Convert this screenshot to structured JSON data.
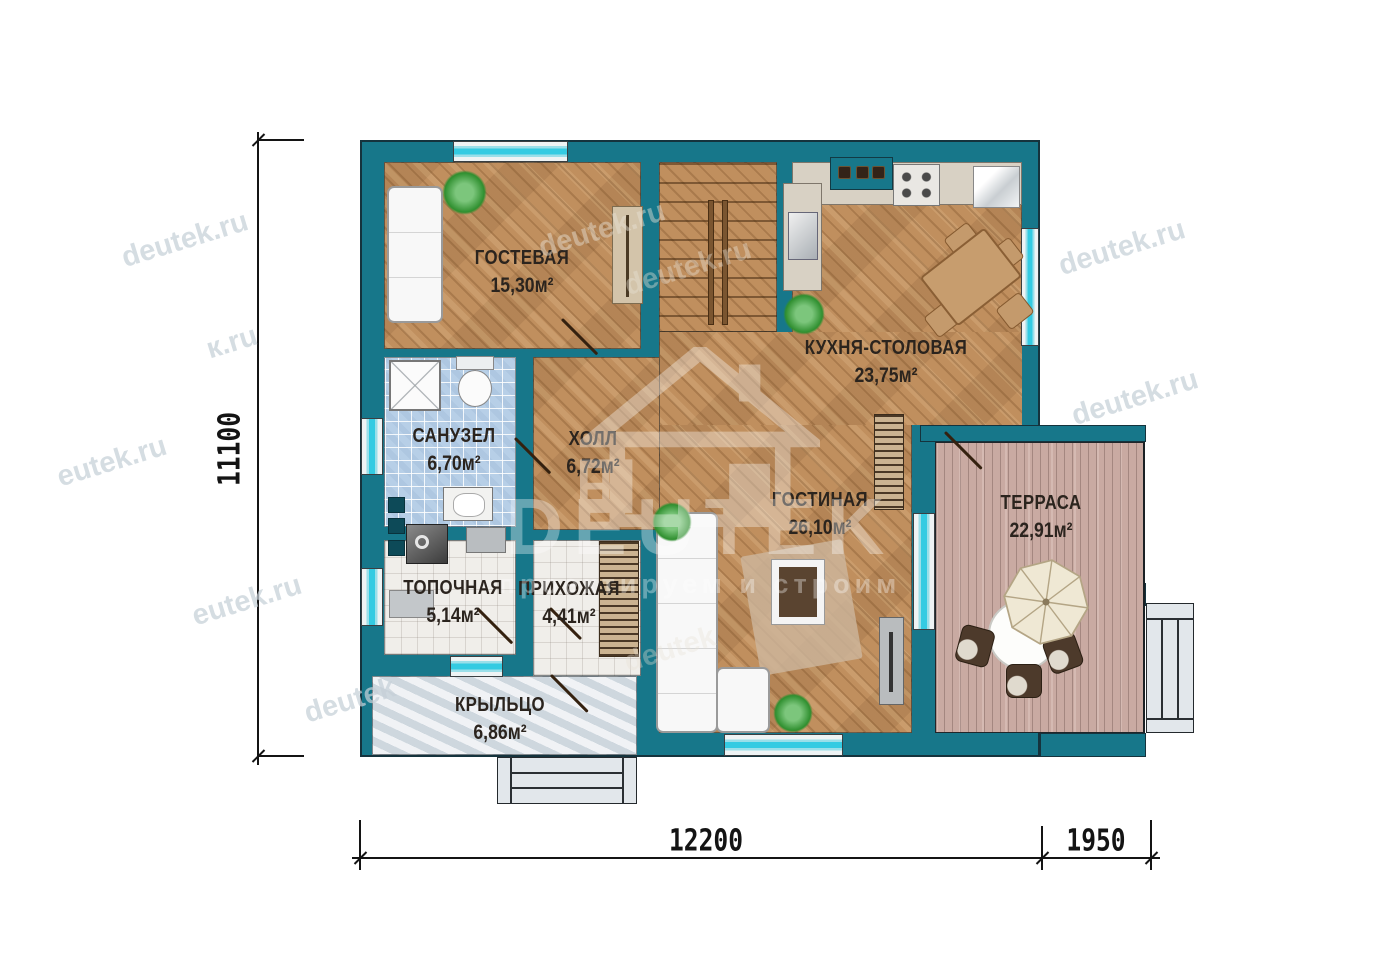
{
  "rooms": [
    {
      "name": "ГОСТЕВАЯ",
      "area": "15,30м²"
    },
    {
      "name": "КУХНЯ-СТОЛОВАЯ",
      "area": "23,75м²"
    },
    {
      "name": "САНУЗЕЛ",
      "area": "6,70м²"
    },
    {
      "name": "ХОЛЛ",
      "area": "6,72м²"
    },
    {
      "name": "ГОСТИНАЯ",
      "area": "26,10м²"
    },
    {
      "name": "ТЕРРАСА",
      "area": "22,91м²"
    },
    {
      "name": "ТОПОЧНАЯ",
      "area": "5,14м²"
    },
    {
      "name": "ПРИХОЖАЯ",
      "area": "4,41м²"
    },
    {
      "name": "КРЫЛЬЦО",
      "area": "6,86м²"
    }
  ],
  "dimensions": {
    "left_vertical": "11100",
    "bottom_main": "12200",
    "bottom_terrace": "1950"
  },
  "watermarks": [
    {
      "text": "deutek.ru"
    },
    {
      "text": "к.ru"
    },
    {
      "text": "eutek.ru"
    },
    {
      "text": "eutek.ru"
    },
    {
      "text": "deutek"
    },
    {
      "text": "deutek.ru"
    },
    {
      "text": "deutek.ru"
    },
    {
      "text": "deutek.ru"
    },
    {
      "text": "deutek.ru"
    },
    {
      "text": "deutek"
    }
  ],
  "logo": {
    "title": "DEUTEK",
    "subtitle": "проектируем и строим"
  },
  "colors": {
    "wall": "#17778a",
    "window_glass": "#34cbe2",
    "wood": "#c08f5e",
    "deck": "#c9aaa2",
    "bath_tile": "#b7cfe7"
  }
}
